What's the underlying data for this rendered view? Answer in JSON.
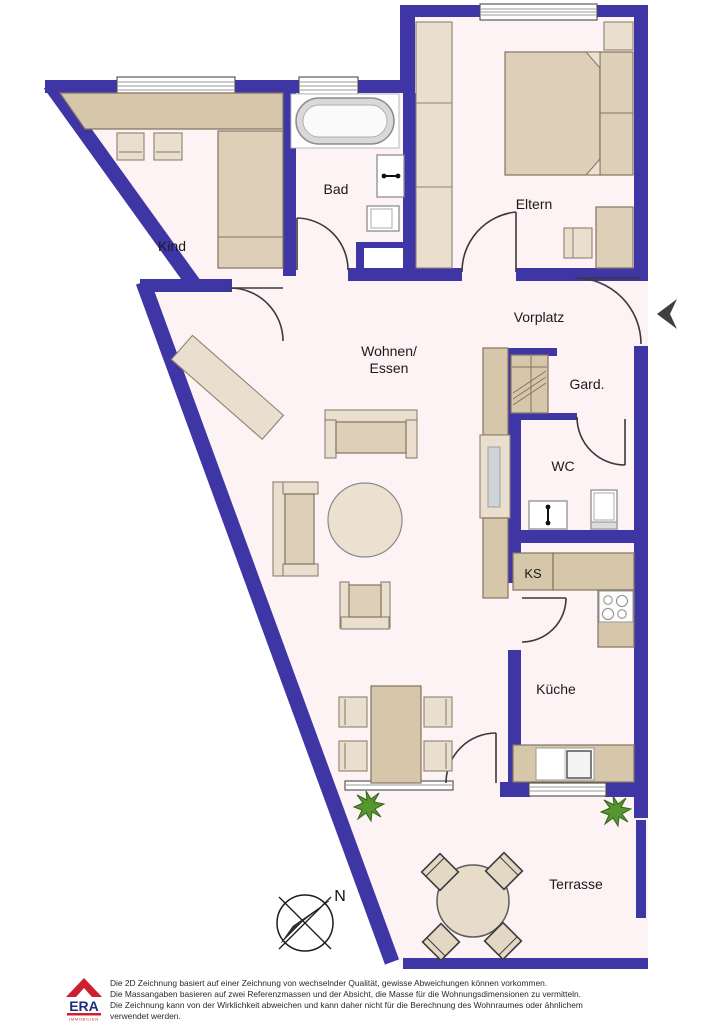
{
  "plan": {
    "type": "2D apartment floor plan",
    "colors": {
      "wall": "#3f36a6",
      "floor": "#fdf2f4",
      "furniture": "#ddcfb8",
      "plant": "#55962e",
      "logo_red": "#cc2030",
      "logo_blue": "#1d2d7c"
    }
  },
  "rooms": {
    "kind": "Kind",
    "bad": "Bad",
    "eltern": "Eltern",
    "vorplatz": "Vorplatz",
    "wohnen_line1": "Wohnen/",
    "wohnen_line2": "Essen",
    "gard": "Gard.",
    "wc": "WC",
    "ks": "KS",
    "kueche": "Küche",
    "terrasse": "Terrasse"
  },
  "compass": {
    "north_label": "N"
  },
  "legal": {
    "line1": "Die 2D Zeichnung basiert auf einer Zeichnung von wechselnder Qualität, gewisse Abweichungen können vorkommen.",
    "line2": "Die Massangaben basieren auf zwei Referenzmassen und der Absicht, die Masse für die Wohnungsdimensionen zu vermitteln.",
    "line3": "Die Zeichnung kann von der Wirklichkeit abweichen und kann daher nicht für die Berechnung des Wohnraumes oder ähnlichem",
    "line4": "verwendet werden."
  },
  "logo": {
    "brand": "ERA",
    "division": "IMMOBILIEN"
  }
}
